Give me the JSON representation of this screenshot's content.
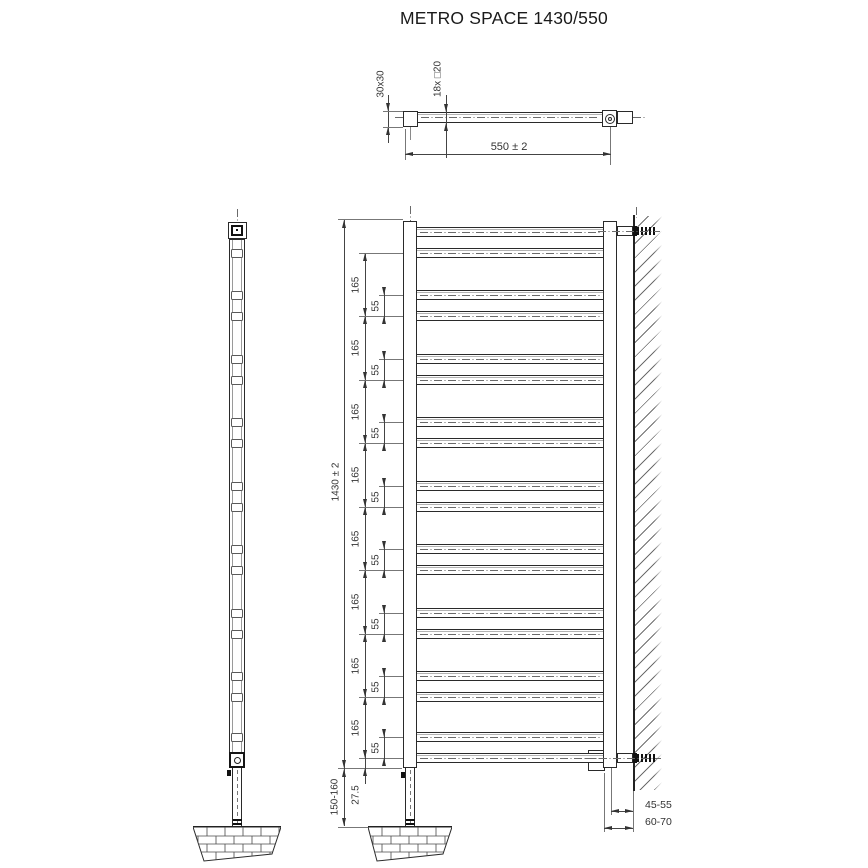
{
  "title": "METRO SPACE 1430/550",
  "top_view": {
    "cap_size_label": "30x30",
    "rung_spec_label": "18x □20",
    "width_label": "550 ± 2"
  },
  "front_view": {
    "height_label": "1430 ± 2",
    "rung_count": 18,
    "spacing_large_labels": [
      "165",
      "165",
      "165",
      "165",
      "165",
      "165",
      "165",
      "165"
    ],
    "spacing_small_labels": [
      "55",
      "55",
      "55",
      "55",
      "55",
      "55",
      "55",
      "55"
    ],
    "bottom_offset_label": "27.5",
    "floor_clearance_label": "150-160",
    "wall_distance_upper_label": "45-55",
    "wall_distance_lower_label": "60-70"
  }
}
